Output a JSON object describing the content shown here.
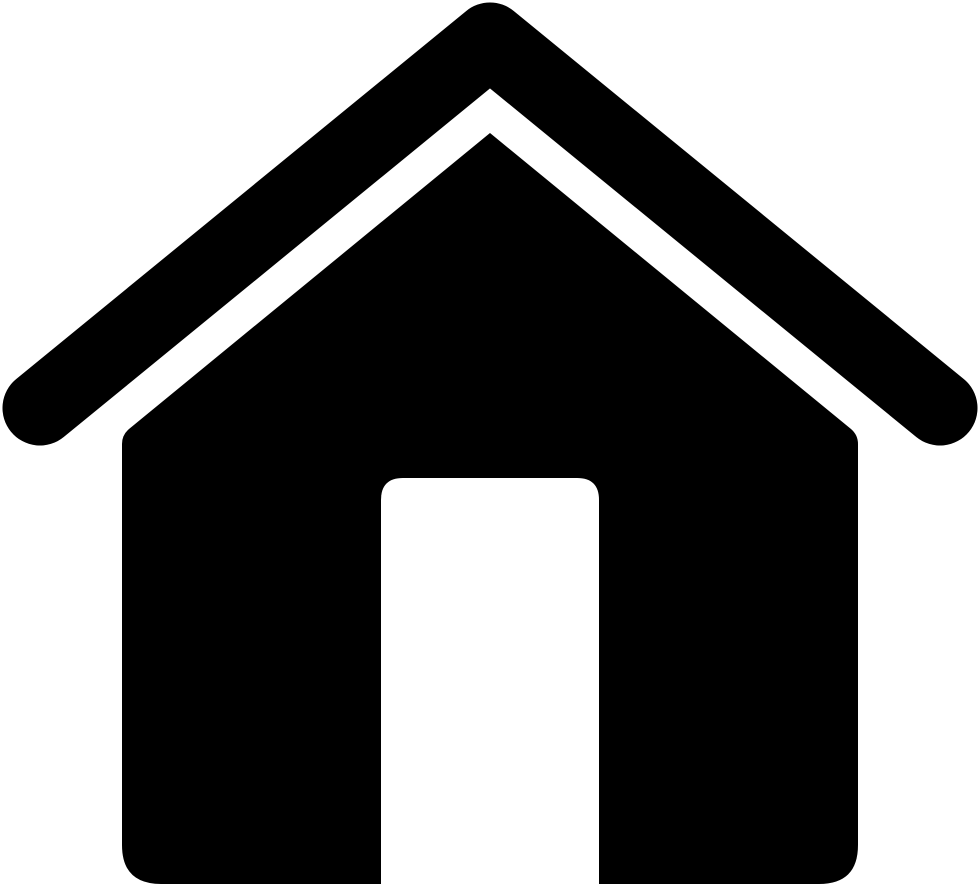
{
  "icon": {
    "name": "home-icon",
    "description": "Solid black house (home) icon with detached chevron roof and open doorway, on a white background",
    "glyph_color": "#000000",
    "background_color": "#ffffff",
    "canvas_width": "980",
    "canvas_height": "886"
  }
}
